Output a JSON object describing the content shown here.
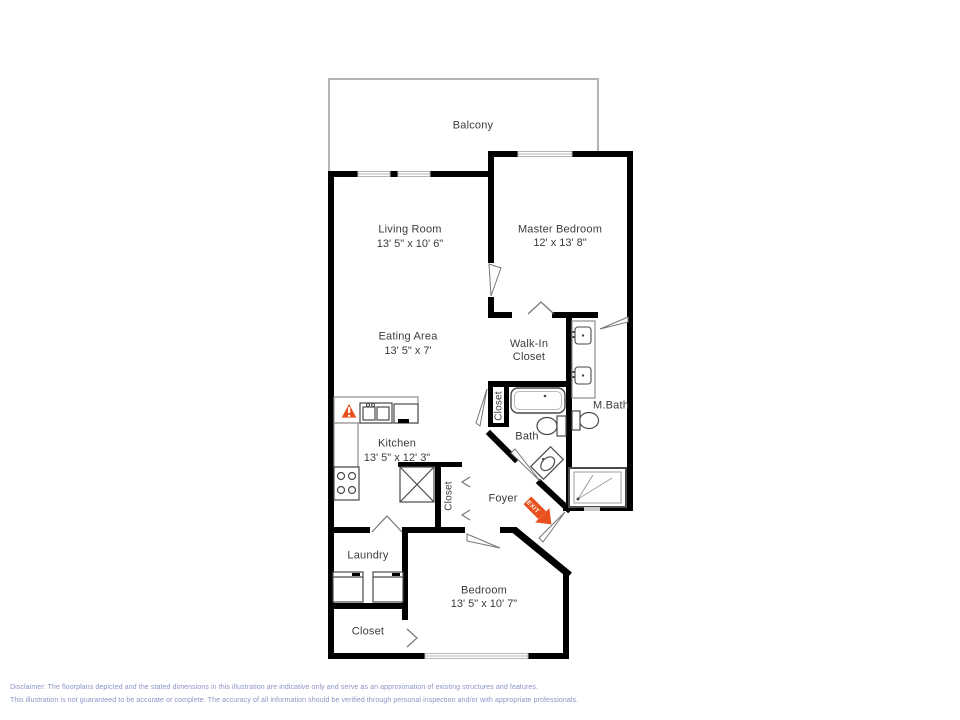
{
  "rooms": {
    "balcony": {
      "name": "Balcony"
    },
    "living_room": {
      "name": "Living Room",
      "dims": "13' 5\" x 10' 6\""
    },
    "master_bedroom": {
      "name": "Master Bedroom",
      "dims": "12' x 13' 8\""
    },
    "eating_area": {
      "name": "Eating Area",
      "dims": "13' 5\" x 7'"
    },
    "walk_in_closet": {
      "name": "Walk-In Closet"
    },
    "kitchen": {
      "name": "Kitchen",
      "dims": "13' 5\" x 12' 3\""
    },
    "hall_closet": {
      "name": "Closet"
    },
    "bath": {
      "name": "Bath"
    },
    "master_bath": {
      "name": "M.Bath"
    },
    "foyer": {
      "name": "Foyer"
    },
    "foyer_closet": {
      "name": "Closet"
    },
    "laundry": {
      "name": "Laundry"
    },
    "bedroom": {
      "name": "Bedroom",
      "dims": "13' 5\" x 10' 7\""
    },
    "bedroom_closet": {
      "name": "Closet"
    }
  },
  "annotations": {
    "exit_label": "EXIT"
  },
  "disclaimer": {
    "line1": "Disclaimer: The floorplans depicted and the stated dimensions in this illustration are indicative only and serve as an approximation of existing structures and features.",
    "line2": "This illustration is not guaranteed to be accurate or complete. The accuracy of all information should be verified through personal inspection and/or with appropriate professionals."
  },
  "colors": {
    "wall": "#000000",
    "window": "#b5b5b5",
    "accent": "#E8511E",
    "disclaimer_text": "#8C93C4"
  }
}
